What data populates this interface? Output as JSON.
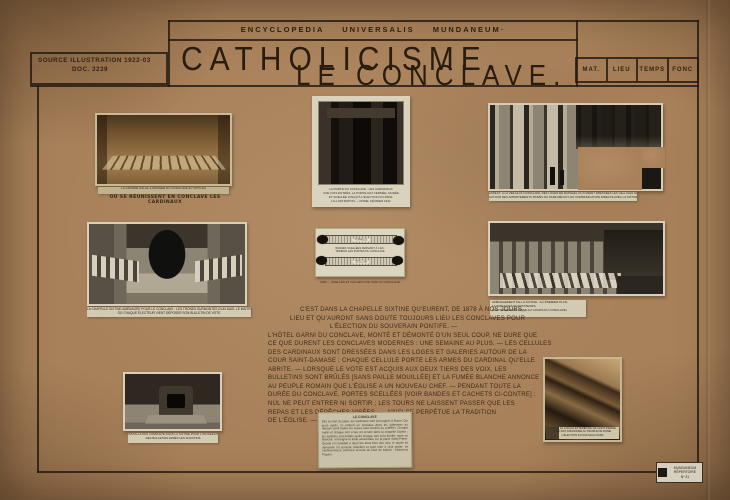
{
  "header": {
    "encyclopedia": "ENCYCLOPEDIA  UNIVERSALIS  MUNDANEUM·",
    "title_line1": "CATHOLICISME.",
    "title_line2": "LE CONCLAVE.",
    "source_line1": "SOURCE ILLUSTRATION 1922-03",
    "source_line2": "DOC. 3239",
    "columns": [
      "MAT.",
      "LIEU",
      "TEMPS",
      "FONC"
    ]
  },
  "photos": {
    "refectory": {
      "caption_printed": "LA GRANDE SALLE À MANGER DU CONCLAVE AU VATICAN",
      "caption_hand": "OÙ SE RÉUNISSENT EN CONCLAVE LES CARDINAUX"
    },
    "walled_door": {
      "caption_lines": [
        "LA PORTE DU CONCLAVE : LES CARDINAUX",
        "UNE FOIS ENTRÉS, LA PORTE EST FERMÉE, MURÉE",
        "ET SCELLÉE JUSQU'À L'ÉLECTION DU PAPE.",
        "L'ILLUSTRATION — ROME, FÉVRIER 1922"
      ]
    },
    "loggia": {
      "caption_lines": [
        "ASPECT, À LA VEILLE DU CONCLAVE, DES LOGES DE RAPHAËL OÙ FURENT DRESSÉES LES CELLULES DES CARDINAUX",
        "AUTOUR DES APPARTEMENTS PRIVÉS DU PAPE DÉFUNT, EN COMMUNICATION DIRECTE AVEC LA SIXTINE"
      ]
    },
    "thrones": {
      "caption_lines": [
        "LA CHAPELLE SIXTINE AMÉNAGÉE POUR LE CONCLAVE : LES TRÔNES SURMONTÉS D'UN DAIS, LE MAÎTRE-AUTEL, ET LES TABLES DES CARDINAUX",
        "OÙ CHAQUE ÉLECTEUR VIENT DÉPOSER SON BULLETIN DE VOTE"
      ]
    },
    "seals": {
      "strip_label_top": "FORMULE",
      "strip_label_bottom": "SIGILLUM",
      "middle_lines": [
        "BANDES SCELLÉES FERMANT À L'EX-",
        "TÉRIEUR LES PORTES DU CONCLAVE"
      ],
      "caption": "1922 — SCELLÉS ET CACHETS DE CIRE DU CONCLAVE"
    },
    "sixtine_tables": {
      "caption_lines": [
        "AMÉNAGEMENT DE LA SIXTINE : AU PREMIER PLAN,",
        "LA TABLE DES SCRUTATEURS.",
        "(PHOTOGRAPHIE PRISE AU COURS DU CONCLAVE)"
      ]
    },
    "stove": {
      "caption_lines": [
        "INSTALLATION COMPLÈTE DANS LA SIXTINE POUR L'INCINÉRATION",
        "DES BULLETINS APRÈS LES SCRUTINS"
      ]
    },
    "exterior_loggia": {
      "caption_lines": [
        "VUE DE LA LOGGIA EXTÉRIEURE DE SAINT-PIERRE",
        "D'OÙ EST ANNONCÉE AU PEUPLE DE ROME",
        "L'ÉLECTION DU NOUVEAU PAPE"
      ]
    }
  },
  "handwriting": {
    "lines": [
      "C'EST DANS LA CHAPELLE SIXTINE QU'EURENT, DE 1878 À NOS JOURS,",
      "LIEU ET QU'AURONT SANS DOUTE TOUJOURS LIEU LES CONCLAVES POUR",
      "L'ÉLECTION DU SOUVERAIN PONTIFE. —",
      "L'HÔTEL GARNI DU CONCLAVE, MONTÉ ET DÉMONTÉ D'UN SEUL COUP, NE DURE QUE",
      "CE QUE DURENT LES CONCLAVES MODERNES : UNE SEMAINE AU PLUS. — LES CELLULES",
      "DES CARDINAUX SONT DRESSÉES DANS LES LOGES ET GALERIES AUTOUR DE LA",
      "COUR SAINT-DAMASE ; CHAQUE CELLULE PORTE LES ARMES DU CARDINAL QU'ELLE",
      "ABRITE. — LORSQUE LE VOTE EST ACQUIS AUX DEUX TIERS DES VOIX, LES",
      "BULLETINS SONT BRÛLÉS [SANS PAILLE MOUILLÉE] ET LA FUMÉE BLANCHE ANNONCE",
      "AU PEUPLE ROMAIN QUE L'ÉGLISE A UN NOUVEAU CHEF. — PENDANT TOUTE LA",
      "DURÉE DU CONCLAVE, PORTES SCELLÉES [VOIR BANDES ET CACHETS CI-CONTRE] :",
      "NUL NE PEUT ENTRER NI SORTIR ; LES TOURS NE LAISSENT PASSER QUE LES",
      "REPAS ET LES DÉPÊCHES VISÉES. — AINSI SE PERPÉTUE LA TRADITION",
      "DE L'ÉGLISE. —"
    ]
  },
  "clipping": {
    "heading": "LE CONCLAVE",
    "body": "Dès la mort du pape, les cardinaux sont convoqués à Rome. Dix jours après, ils entrent en conclave dans les bâtiments du Vatican, dont toutes les issues sont murées ou scellées. Chaque matin et chaque soir a lieu un scrutin dans la chapelle Sixtine ; les bulletins sont brûlés après chaque tour et la fumée, noire ou blanche, renseigne la foule assemblée sur la place Saint-Pierre. Quand un candidat a réuni les deux tiers des voix, le doyen lui demande s'il accepte l'élection et quel nom il veut porter. Le cardinal-diacre annonce ensuite du haut du balcon : Habemus Papam."
  },
  "stamp": {
    "lines": [
      "MUNDANEUM",
      "RÉPERTOIRE",
      "Nº 31"
    ]
  }
}
